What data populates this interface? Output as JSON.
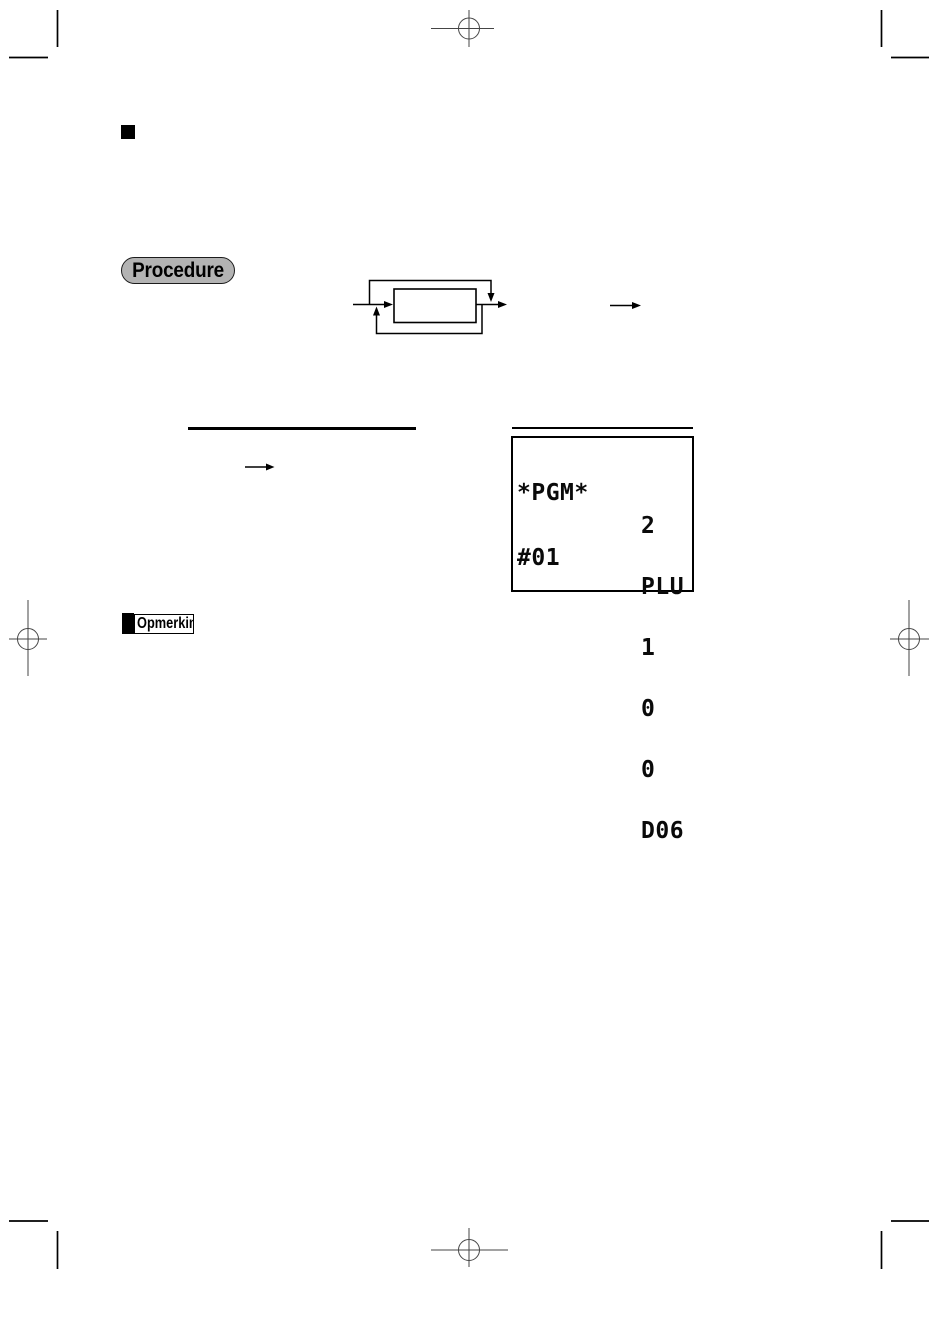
{
  "page": {
    "background": "#ffffff",
    "ink_color": "#000000",
    "crop_mark_color": "#454545",
    "procedure_fill": "#b3b3b3"
  },
  "icons": {
    "section_marker": "black-square",
    "note_marker": "black-bar",
    "flow_arrows": "right-arrow, down-arrow, up-arrow",
    "crop_marks": "crosshair-circle"
  },
  "badges": {
    "procedure_label": "Procedure",
    "note_label": "Opmerking"
  },
  "register_display": {
    "left_lines": [
      "*PGM*",
      "#01"
    ],
    "right_lines": [
      "2",
      "PLU",
      "1",
      "0",
      "0",
      "D06"
    ]
  }
}
